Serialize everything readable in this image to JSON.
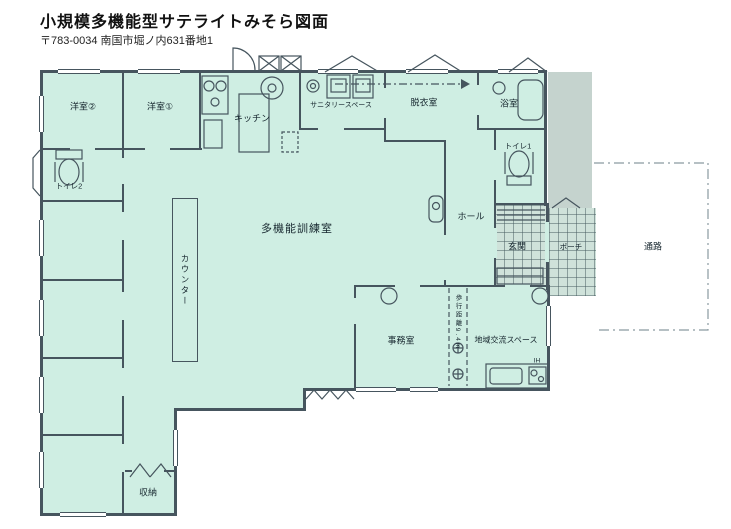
{
  "header": {
    "title": "小規模多機能型サテライトみそら図面",
    "address": "〒783-0034 南国市堀ノ内631番地1"
  },
  "colors": {
    "room_fill": "#cfeee3",
    "wall": "#46555e",
    "veranda_fill": "#c5d3ce",
    "tile_fill": "#cfe2da",
    "background": "#ffffff"
  },
  "rooms": {
    "yoshitsu1": {
      "label": "洋室①"
    },
    "yoshitsu2": {
      "label": "洋室②"
    },
    "yoshitsu3": {
      "label": "洋室③"
    },
    "yoshitsu4": {
      "label": "洋室④"
    },
    "yoshitsu5": {
      "label": "洋室⑤"
    },
    "yoshitsu6": {
      "label": "洋室⑥"
    },
    "kitchen": {
      "label": "キッチン"
    },
    "sanitary": {
      "label": "サニタリースペース"
    },
    "dressing": {
      "label": "脱衣室"
    },
    "bath": {
      "label": "浴室"
    },
    "toilet1": {
      "label": "トイレ1"
    },
    "toilet2": {
      "label": "トイレ2"
    },
    "hall": {
      "label": "ホール"
    },
    "genkan": {
      "label": "玄関"
    },
    "porch": {
      "label": "ポーチ"
    },
    "passage": {
      "label": "通路"
    },
    "training": {
      "label": "多機能訓練室"
    },
    "counter": {
      "label": "カウンター"
    },
    "office": {
      "label": "事務室"
    },
    "community": {
      "label": "地域交流スペース"
    },
    "storage": {
      "label": "収納"
    }
  },
  "annotations": {
    "walking_distance": "歩行距離9.4m",
    "ih_label": "IH"
  }
}
